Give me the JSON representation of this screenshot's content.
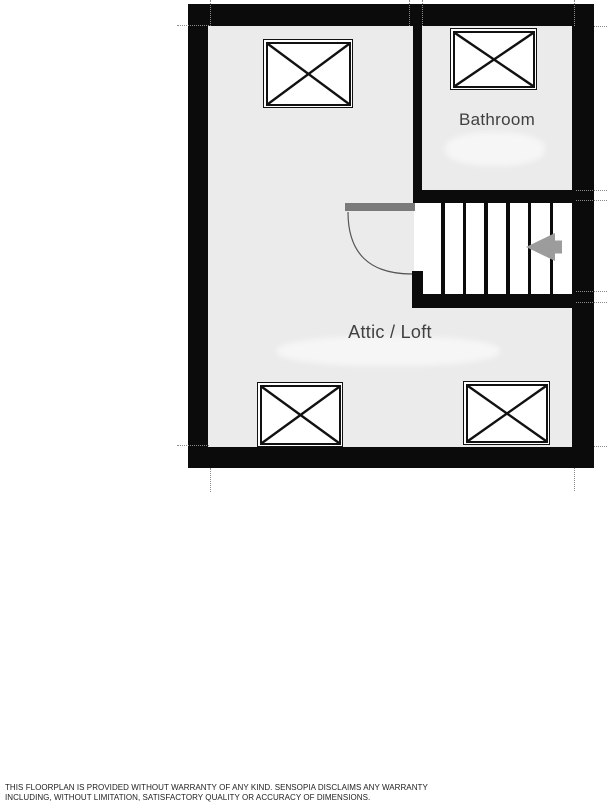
{
  "plan": {
    "type": "floorplan",
    "floor_name": "Attic / Loft level",
    "rooms": [
      {
        "id": "bathroom",
        "label": "Bathroom"
      },
      {
        "id": "attic",
        "label": "Attic / Loft"
      }
    ],
    "stairs": {
      "treads": 6,
      "direction_icon": "arrow-left-icon"
    },
    "skylights": {
      "count": 4,
      "symbol": "crossed-window"
    },
    "door": {
      "type": "swing-door",
      "swing": "quarter-arc"
    }
  },
  "disclaimer": {
    "line1": "THIS FLOORPLAN IS PROVIDED WITHOUT WARRANTY OF ANY KIND. SENSOPIA DISCLAIMS ANY WARRANTY",
    "line2": "INCLUDING, WITHOUT LIMITATION, SATISFACTORY QUALITY OR ACCURACY OF DIMENSIONS."
  },
  "colors": {
    "wall": "#0b0b0b",
    "floor": "#ebebeb",
    "stair_white": "#ffffff",
    "door_leaf": "#7a7a7a",
    "arrow": "#9c9c9c",
    "label_text": "#404040",
    "disclaimer_text": "#222222"
  }
}
